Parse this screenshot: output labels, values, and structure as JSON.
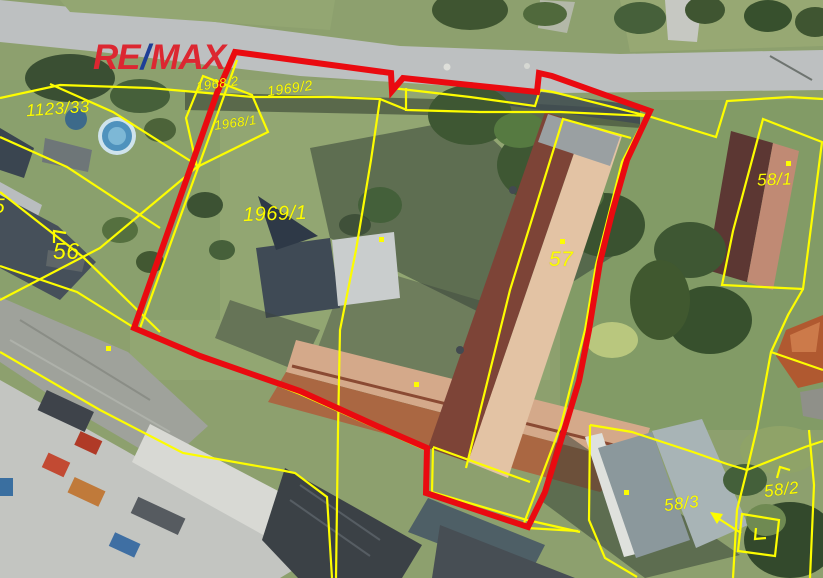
{
  "logo": {
    "part1": "RE",
    "slash": "/",
    "part2": "MAX"
  },
  "colors": {
    "boundary_red": "#ea0a10",
    "line_yellow": "#fdfd00",
    "label_yellow": "#fdfd00",
    "logo_red": "#dc2731",
    "logo_blue": "#1e3f97"
  },
  "parcel_labels": [
    {
      "label": "1123/33"
    },
    {
      "label": "1968/2"
    },
    {
      "label": "1969/2"
    },
    {
      "label": "1968/1"
    },
    {
      "label": "1969/1"
    },
    {
      "label": "56"
    },
    {
      "label": "5"
    },
    {
      "label": "57"
    },
    {
      "label": "58/1"
    },
    {
      "label": "58/2"
    },
    {
      "label": "58/3"
    }
  ],
  "symbols": {
    "boundary_point_dots": [
      {
        "x": 106,
        "y": 346
      },
      {
        "x": 379,
        "y": 237
      },
      {
        "x": 414,
        "y": 382
      },
      {
        "x": 560,
        "y": 239
      },
      {
        "x": 786,
        "y": 161
      },
      {
        "x": 624,
        "y": 490
      }
    ],
    "corner_marks": 3,
    "arrow_target": "58/3"
  }
}
